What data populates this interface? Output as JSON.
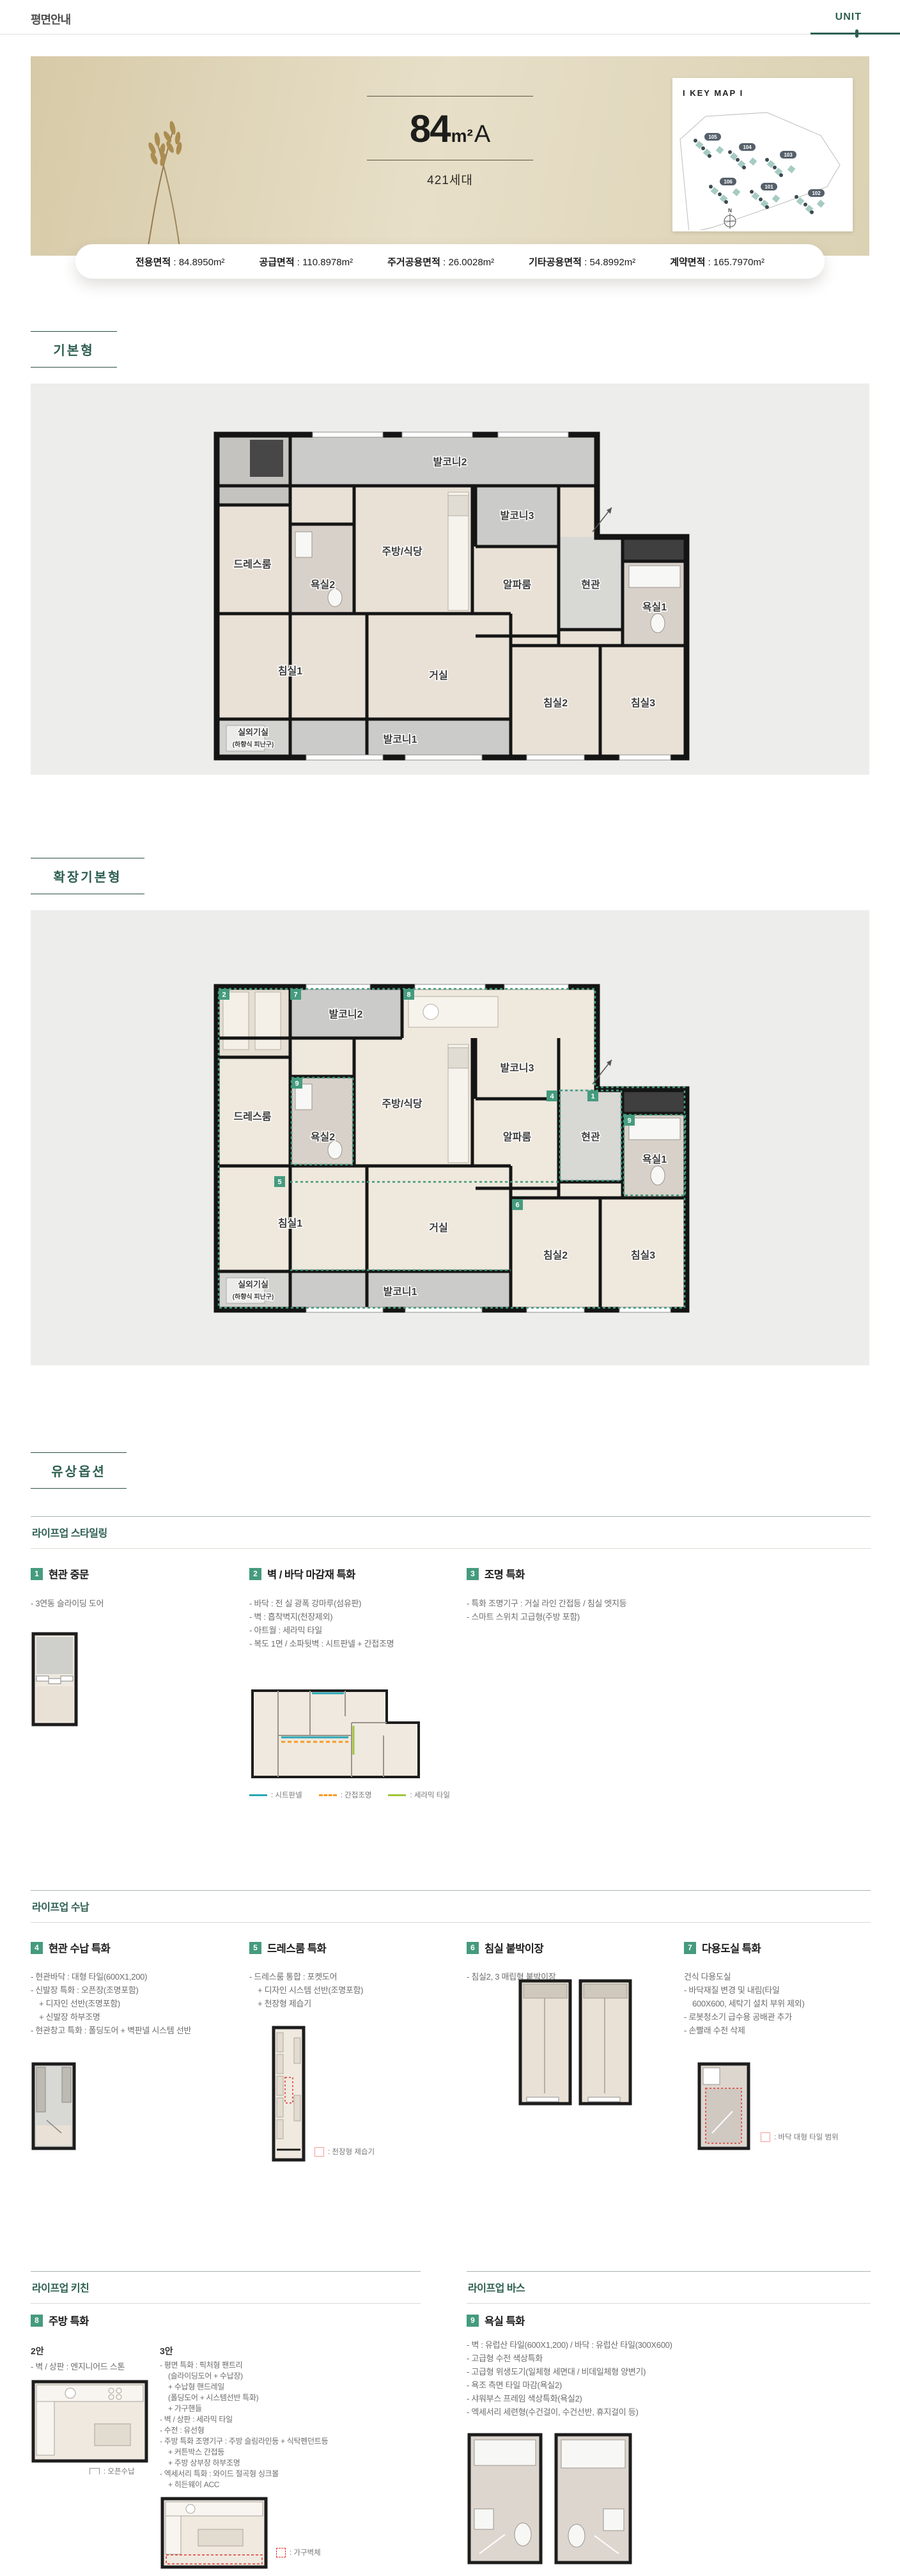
{
  "header": {
    "title": "평면안내",
    "tab": "UNIT"
  },
  "hero": {
    "size": "84",
    "unit": "m²",
    "type": "A",
    "households": "421세대",
    "keymap": {
      "title": "I KEY MAP I",
      "compass": "N",
      "buildings": [
        "105",
        "104",
        "103",
        "106",
        "101",
        "102"
      ]
    }
  },
  "area_info": {
    "items": [
      {
        "label": "전용면적",
        "value": "84.8950m²"
      },
      {
        "label": "공급면적",
        "value": "110.8978m²"
      },
      {
        "label": "주거공용면적",
        "value": "26.0028m²"
      },
      {
        "label": "기타공용면적",
        "value": "54.8992m²"
      },
      {
        "label": "계약면적",
        "value": "165.7970m²"
      }
    ]
  },
  "sections": {
    "basic_label": "기본형",
    "extended_label": "확장기본형",
    "paid_label": "유상옵션"
  },
  "rooms": {
    "balcony2": "발코니2",
    "dress": "드레스룸",
    "bath2": "욕실2",
    "kitchen": "주방/식당",
    "balcony3": "발코니3",
    "alpha": "알파룸",
    "entrance": "현관",
    "bath1": "욕실1",
    "bed1": "침실1",
    "living": "거실",
    "bed2": "침실2",
    "bed3": "침실3",
    "balcony1": "발코니1",
    "outdoor_unit": "실외기실",
    "outdoor_unit_sub": "(하향식 피난구)"
  },
  "extended_badges": [
    "2",
    "7",
    "8",
    "9",
    "5",
    "4",
    "1",
    "9",
    "6"
  ],
  "groups": {
    "styling": {
      "title": "라이프업 스타일링",
      "item1": {
        "no": "1",
        "title": "현관 중문",
        "b1": "- 3연동 슬라이딩 도어"
      },
      "item2": {
        "no": "2",
        "title": "벽 / 바닥 마감재 특화",
        "b1": "- 바닥 : 전 실 광폭 강마루(섬유판)",
        "b2": "- 벽 : 흡착벽지(천장제외)",
        "b3": "- 아트월 : 세라믹 타일",
        "b4": "- 복도 1면 / 소파뒷벽 : 시트판넬 + 간접조명",
        "legend1": ": 시트판넬",
        "legend2": ": 간접조명",
        "legend3": ": 세라믹 타일"
      },
      "item3": {
        "no": "3",
        "title": "조명 특화",
        "b1": "- 특화 조명기구 : 거실 라인 간접등 / 침실 엣지등",
        "b2": "- 스마트 스위치 고급형(주방 포함)"
      }
    },
    "storage": {
      "title": "라이프업 수납",
      "item4": {
        "no": "4",
        "title": "현관 수납 특화",
        "b1": "- 현관바닥 : 대형 타일(600X1,200)",
        "b2": "- 신발장 특화 : 오픈장(조명포함)",
        "b3": "+ 디자인 선반(조명포함)",
        "b4": "+ 신발장 하부조명",
        "b5": "- 현관창고 특화 : 폴딩도어 + 벽판넬 시스템 선반"
      },
      "item5": {
        "no": "5",
        "title": "드레스룸 특화",
        "b1": "- 드레스룸 통합 : 포켓도어",
        "b2": "+ 디자인 시스템 선반(조명포함)",
        "b3": "+ 천장형 제습기",
        "legend": ": 천장형 제습기"
      },
      "item6": {
        "no": "6",
        "title": "침실 붙박이장",
        "b1": "- 침실2, 3 매립형 붙박이장"
      },
      "item7": {
        "no": "7",
        "title": "다용도실 특화",
        "b1": "건식 다용도실",
        "b2": "- 바닥재질 변경 및 내림(타일",
        "b3": "600X600, 세탁기 설치 부위 제외)",
        "b4": "- 로봇청소기 급수용 공배관 추가",
        "b5": "- 손빨래 수전 삭제",
        "legend": ": 바닥 대형 타일 범위"
      }
    },
    "kitchen": {
      "title": "라이프업 키친",
      "item8": {
        "no": "8",
        "title": "주방 특화",
        "v2": {
          "name": "2안",
          "b1": "- 벽 / 상판 : 엔지니어드 스톤",
          "legend": ": 오픈수납"
        },
        "v3": {
          "name": "3안",
          "b1": "- 평면 특화 : 픽처형 팬트리",
          "b2": "(슬라이딩도어 + 수납장)",
          "b3": "+ 수납형 핸드레일",
          "b4": "(폴딩도어 + 시스템선반 특화)",
          "b5": "+ 가구핸들",
          "b6": "- 벽 / 상판 : 세라믹 타일",
          "b7": "- 수전 : 유선형",
          "b8": "- 주방 특화 조명기구 : 주방 슬림라인등 + 식탁펜던트등",
          "b9": "+ 커튼박스 간접등",
          "b10": "+ 주방 상부장 하부조명",
          "b11": "- 엑세서리 특화 : 와이드 절곡형 싱크볼",
          "b12": "+ 히든웨이 ACC",
          "legend": ": 가구벽체"
        }
      }
    },
    "bath": {
      "title": "라이프업 바스",
      "item9": {
        "no": "9",
        "title": "욕실 특화",
        "b1": "- 벽 : 유럽산 타일(600X1,200) / 바닥 : 유럽산 타일(300X600)",
        "b2": "- 고급형 수전 색상특화",
        "b3": "- 고급형 위생도기(일체형 세면대 / 비데일체형 양변기)",
        "b4": "- 욕조 측면 타일 마감(욕실2)",
        "b5": "- 샤워부스 프레임 색상특화(욕실2)",
        "b6": "- 엑세서리 세련형(수건걸이, 수건선반, 휴지걸이 등)"
      }
    }
  },
  "colors": {
    "accent": "#2d5f51",
    "badge_green": "#459b7e",
    "legend_teal": "#2ba7b5",
    "legend_orange": "#f59b22",
    "legend_green": "#9fc53a",
    "legend_red": "#e0392e"
  }
}
